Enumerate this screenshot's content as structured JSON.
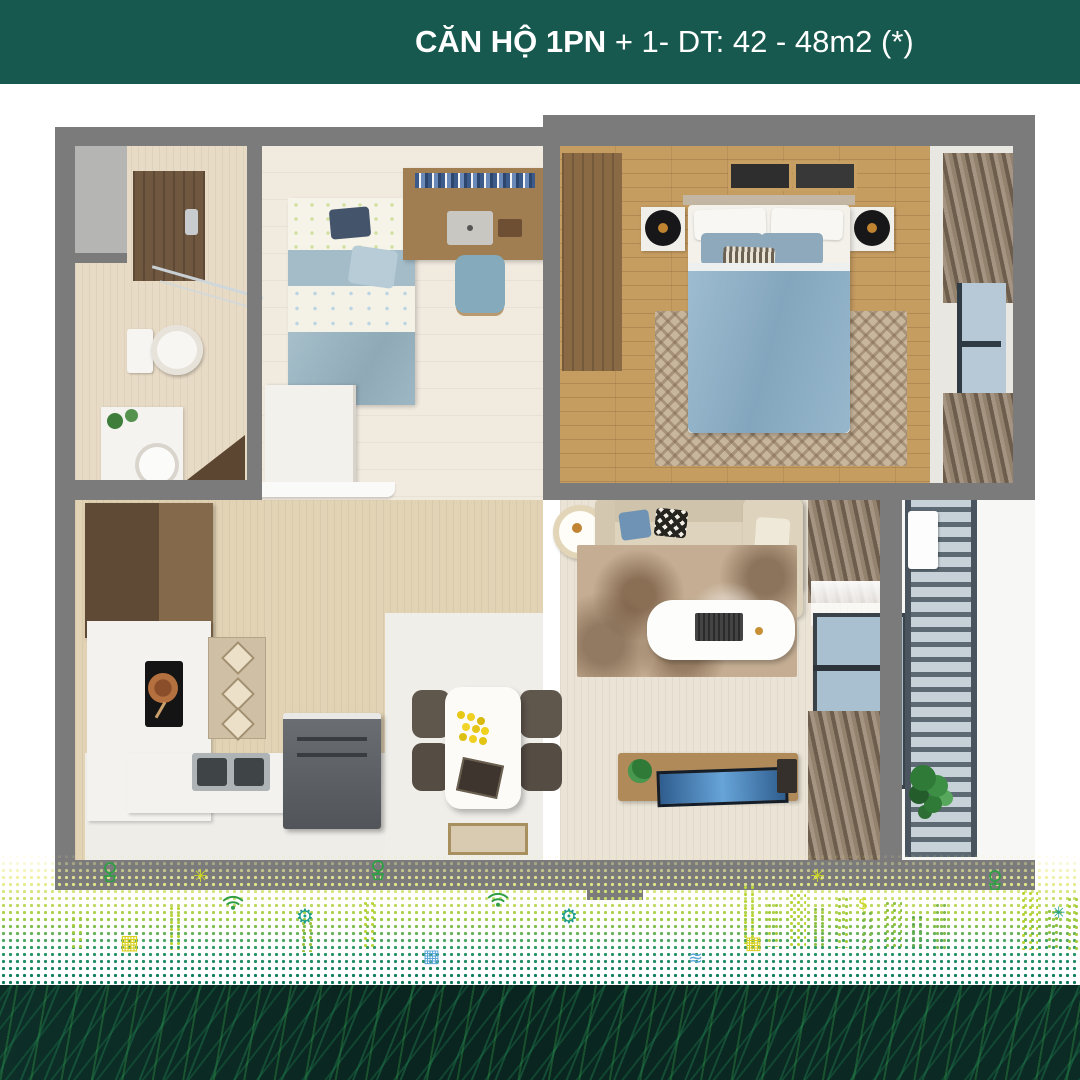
{
  "header": {
    "brand_top": "VINHOMES",
    "brand_left": "SM",
    "brand_right": "RTCITY",
    "title_bold": "CĂN HỘ 1PN",
    "title_rest": " + 1- DT: 42 - 48m2 (*)"
  },
  "footer": {
    "note": "(*) là diện tích thông thủy hay diện tích sử dụng trong căn hộ",
    "site_prefix": "Muanha",
    "site_main": "VinHomes",
    "site_tld": ".vn"
  },
  "colors": {
    "banner_teal": "#17594e",
    "wall_gray": "#7b7b7b",
    "accent_yellow": "#d8cf1b",
    "accent_green": "#2f9e44",
    "accent_teal": "#1e9e8a",
    "footer_dark": "#0a2722"
  },
  "icons": [
    {
      "name": "tree-icon",
      "type": "tree",
      "x": 100,
      "y": 862,
      "size": 20,
      "color": "#2f9e44"
    },
    {
      "name": "sparkle-icon",
      "type": "sun",
      "x": 193,
      "y": 868,
      "size": 18,
      "color": "#cdd61f"
    },
    {
      "name": "tree-icon",
      "type": "tree",
      "x": 368,
      "y": 860,
      "size": 20,
      "color": "#2f9e44"
    },
    {
      "name": "wifi-icon",
      "type": "wifi",
      "x": 222,
      "y": 893,
      "size": 22,
      "color": "#2f9e44"
    },
    {
      "name": "gear-icon",
      "type": "gear",
      "x": 296,
      "y": 906,
      "size": 20,
      "color": "#1e9e8a"
    },
    {
      "name": "building-icon",
      "type": "building",
      "x": 120,
      "y": 932,
      "size": 20,
      "color": "#d8cf1b"
    },
    {
      "name": "wifi-icon",
      "type": "wifi",
      "x": 487,
      "y": 890,
      "size": 22,
      "color": "#2f9e44"
    },
    {
      "name": "gear-icon",
      "type": "gear",
      "x": 560,
      "y": 906,
      "size": 20,
      "color": "#1e9e8a"
    },
    {
      "name": "grid-icon",
      "type": "grid",
      "x": 423,
      "y": 948,
      "size": 18,
      "color": "#5aa7d8"
    },
    {
      "name": "fountain-icon",
      "type": "fountain",
      "x": 688,
      "y": 950,
      "size": 18,
      "color": "#5aa7d8"
    },
    {
      "name": "building-icon",
      "type": "building",
      "x": 745,
      "y": 935,
      "size": 18,
      "color": "#d8cf1b"
    },
    {
      "name": "sparkle-icon",
      "type": "sun",
      "x": 810,
      "y": 868,
      "size": 18,
      "color": "#cdd61f"
    },
    {
      "name": "dollar-icon",
      "type": "dollar",
      "x": 858,
      "y": 896,
      "size": 16,
      "color": "#cdd61f"
    },
    {
      "name": "tree-icon",
      "type": "tree",
      "x": 985,
      "y": 870,
      "size": 20,
      "color": "#2f9e44"
    },
    {
      "name": "sparkle-icon",
      "type": "sun",
      "x": 1052,
      "y": 905,
      "size": 16,
      "color": "#1e9e8a"
    }
  ]
}
